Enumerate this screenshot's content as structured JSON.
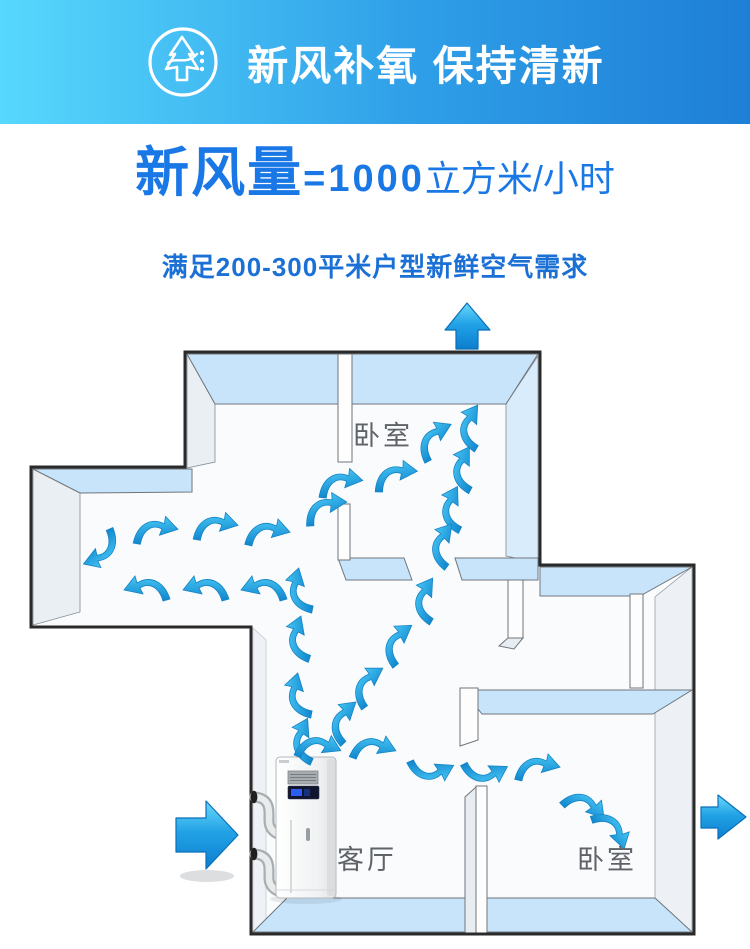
{
  "banner": {
    "title": "新风补氧 保持清新",
    "icon": "fresh-air-tree-arrow-icon",
    "bg_gradient": [
      "#57d8fd",
      "#1e7fd6"
    ],
    "text_color": "#ffffff"
  },
  "headline": {
    "volume_label": "新风量",
    "equals_value": "=1000",
    "unit": "立方米/小时",
    "color": "#1a78e6"
  },
  "subtitle": {
    "text": "满足200-300平米户型新鲜空气需求",
    "color": "#1b70d6"
  },
  "floorplan": {
    "rooms": [
      {
        "id": "bedroom-top",
        "label": "卧室"
      },
      {
        "id": "living-room",
        "label": "客厅"
      },
      {
        "id": "bedroom-bottom",
        "label": "卧室"
      }
    ],
    "colors": {
      "outline": "#2a2a2a",
      "wall_top": "#c8e4fb",
      "wall_face": "#eaeff3",
      "floor": "#f9fbfd",
      "airflow_arrow": "#1d9ae0",
      "label_text": "#5f6368"
    },
    "big_arrows": [
      {
        "name": "inlet-arrow-left"
      },
      {
        "name": "outlet-arrow-top"
      },
      {
        "name": "outlet-arrow-right"
      }
    ],
    "device": {
      "name": "fresh-air-unit"
    }
  }
}
